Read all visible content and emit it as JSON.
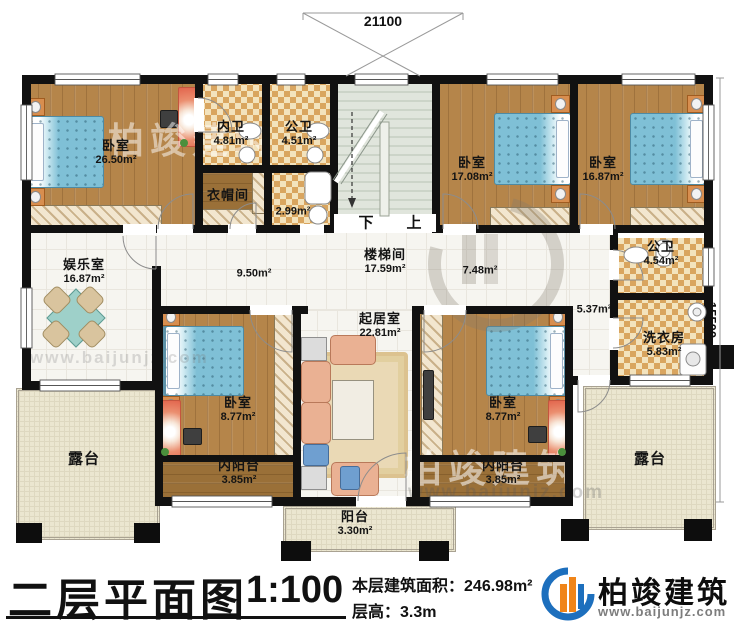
{
  "plan": {
    "dimensions": {
      "top": "21100",
      "right": "15500"
    },
    "stairs": {
      "down": "下",
      "up": "上"
    },
    "rooms": [
      {
        "id": "master-bedroom",
        "name": "卧室",
        "area": "26.50m²"
      },
      {
        "id": "inner-bath",
        "name": "内卫",
        "area": "4.81m²"
      },
      {
        "id": "public-bath-top",
        "name": "公卫",
        "area": "4.51m²"
      },
      {
        "id": "cloakroom",
        "name": "衣帽间",
        "area": ""
      },
      {
        "id": "shower-room",
        "name": "",
        "area": "2.99m²"
      },
      {
        "id": "stairwell",
        "name": "楼梯间",
        "area": "17.59m²"
      },
      {
        "id": "bedroom-2",
        "name": "卧室",
        "area": "17.08m²"
      },
      {
        "id": "bedroom-3",
        "name": "卧室",
        "area": "16.87m²"
      },
      {
        "id": "entertainment-room",
        "name": "娱乐室",
        "area": "16.87m²"
      },
      {
        "id": "hall-left",
        "name": "",
        "area": "9.50m²"
      },
      {
        "id": "hall-right",
        "name": "",
        "area": "7.48m²"
      },
      {
        "id": "public-bath-right",
        "name": "公卫",
        "area": "4.54m²"
      },
      {
        "id": "corridor-right",
        "name": "",
        "area": "5.37m²"
      },
      {
        "id": "laundry-room",
        "name": "洗衣房",
        "area": "5.83m²"
      },
      {
        "id": "living-room",
        "name": "起居室",
        "area": "22.81m²"
      },
      {
        "id": "bedroom-4",
        "name": "卧室",
        "area": "8.77m²"
      },
      {
        "id": "bedroom-5",
        "name": "卧室",
        "area": "8.77m²"
      },
      {
        "id": "inner-balcony-left",
        "name": "内阳台",
        "area": "3.85m²"
      },
      {
        "id": "inner-balcony-right",
        "name": "内阳台",
        "area": "3.85m²"
      },
      {
        "id": "terrace-left",
        "name": "露台",
        "area": ""
      },
      {
        "id": "terrace-right",
        "name": "露台",
        "area": ""
      },
      {
        "id": "balcony",
        "name": "阳台",
        "area": "3.30m²"
      }
    ]
  },
  "title_block": {
    "plan_title": "二层平面图",
    "scale": "1:100",
    "floor_area_label": "本层建筑面积：",
    "floor_area_value": "246.98m²",
    "floor_height_label": "层高：",
    "floor_height_value": "3.3m"
  },
  "logo": {
    "brand": "柏竣建筑",
    "website": "www.baijunjz.com"
  },
  "watermark": {
    "text": "柏竣建筑",
    "url": "www.baijunjz.com"
  },
  "colors": {
    "wall": "#111111",
    "wood_floor": "#b5854a",
    "tile_accent": "#d9a55f",
    "bed_blue": "#7fc0d6",
    "logo_blue": "#1d6fbd",
    "logo_orange": "#f08519"
  }
}
